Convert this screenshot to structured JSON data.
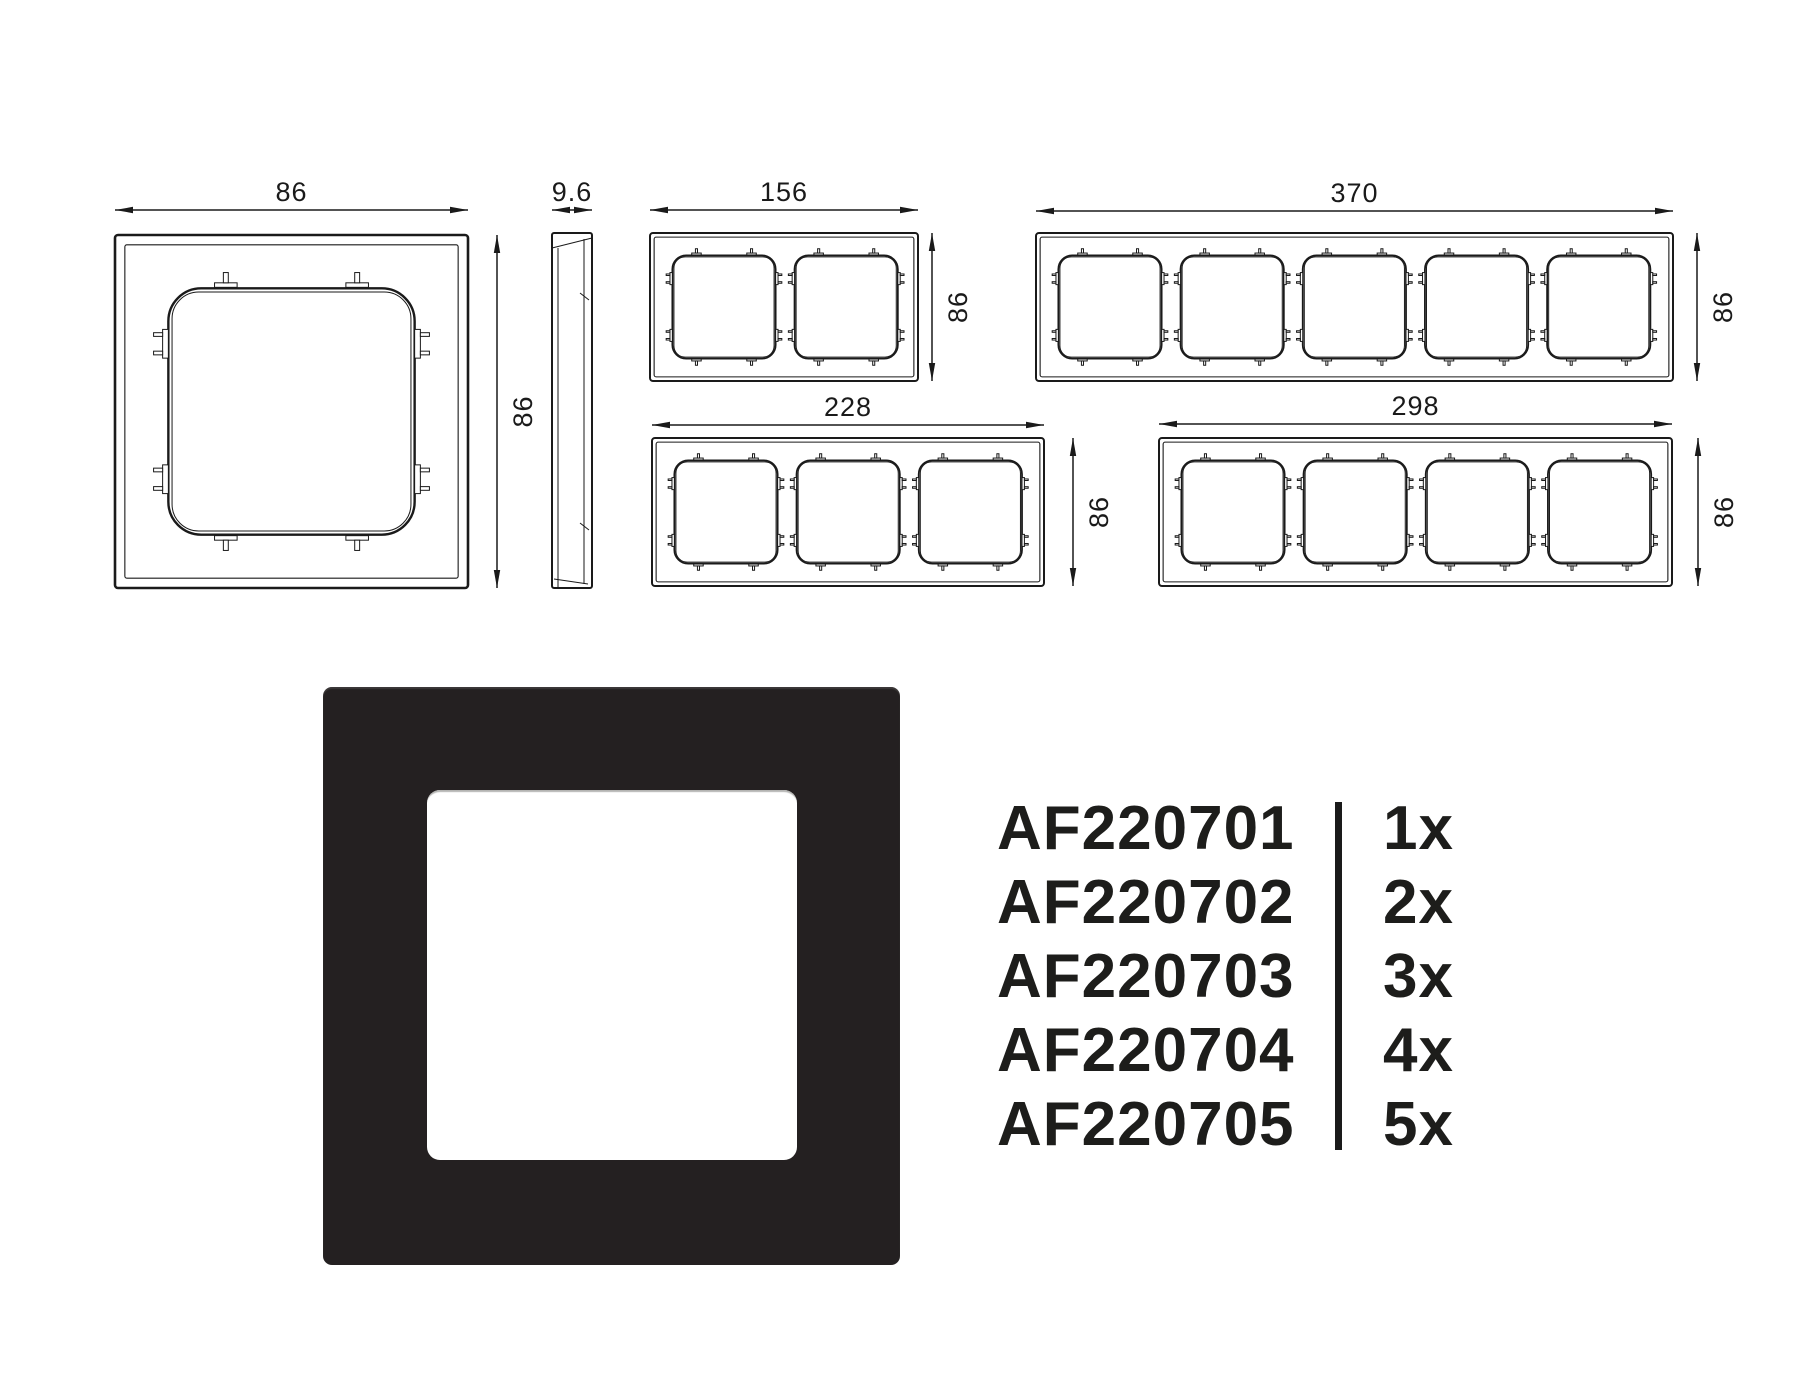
{
  "colors": {
    "line": "#1a1a1a",
    "text": "#1a1a1a",
    "product_black": "#242021",
    "cutout_edge": "#b4b4b2",
    "divider": "#1a1a1a",
    "background": "#ffffff"
  },
  "technical_drawings": {
    "front_views": [
      {
        "name": "frame-1-gang-front-view",
        "gangs": 1,
        "frame": {
          "x": 115,
          "y": 235,
          "w": 353,
          "h": 353
        },
        "width_dim": {
          "label": "86",
          "y": 210
        },
        "height_dim": {
          "label": "86",
          "x": 497
        }
      },
      {
        "name": "frame-2-gang-front-view",
        "gangs": 2,
        "frame": {
          "x": 650,
          "y": 233,
          "w": 268,
          "h": 148
        },
        "width_dim": {
          "label": "156",
          "y": 210
        },
        "height_dim": {
          "label": "86",
          "x": 932
        }
      },
      {
        "name": "frame-5-gang-front-view",
        "gangs": 5,
        "frame": {
          "x": 1036,
          "y": 233,
          "w": 637,
          "h": 148
        },
        "width_dim": {
          "label": "370",
          "y": 211
        },
        "height_dim": {
          "label": "86",
          "x": 1697
        }
      },
      {
        "name": "frame-3-gang-front-view",
        "gangs": 3,
        "frame": {
          "x": 652,
          "y": 438,
          "w": 392,
          "h": 148
        },
        "width_dim": {
          "label": "228",
          "y": 425
        },
        "height_dim": {
          "label": "86",
          "x": 1073
        }
      },
      {
        "name": "frame-4-gang-front-view",
        "gangs": 4,
        "frame": {
          "x": 1159,
          "y": 438,
          "w": 513,
          "h": 148
        },
        "width_dim": {
          "label": "298",
          "y": 424
        },
        "height_dim": {
          "label": "86",
          "x": 1698
        }
      }
    ],
    "side_view": {
      "name": "frame-side-profile-view",
      "frame": {
        "x": 552,
        "y": 233,
        "w": 40,
        "h": 355
      },
      "width_dim": {
        "label": "9.6",
        "y": 210
      }
    }
  },
  "product_photo": {
    "description": "black-1-gang-frame-photo"
  },
  "product_table": {
    "rows": [
      {
        "code": "AF220701",
        "quantity": "1x"
      },
      {
        "code": "AF220702",
        "quantity": "2x"
      },
      {
        "code": "AF220703",
        "quantity": "3x"
      },
      {
        "code": "AF220704",
        "quantity": "4x"
      },
      {
        "code": "AF220705",
        "quantity": "5x"
      }
    ]
  }
}
